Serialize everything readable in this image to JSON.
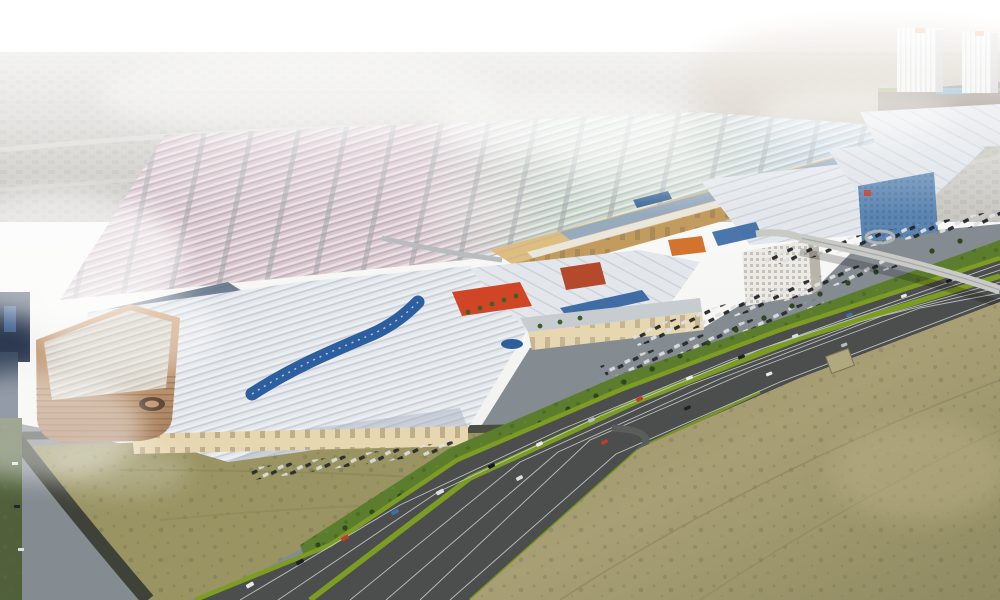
{
  "scene": {
    "kind": "aerial-architectural-rendering",
    "alt": "Bird's-eye rendering of a huge retail and exhibition complex: a colored warehouse-market grid behind, a long tan mall spine with white faceted hall roofs and a curved blue vault, twin white towers upper right, a tan parking garage lower left, lawns and car parks along a multi-lane highway running diagonally, desert in the foreground, haze and fog patches over the scene.",
    "text_content": [],
    "palette": {
      "sky": "#f4f4f1",
      "hazeCity": "#cac8c3",
      "desertFar": "#b5a38a",
      "gridPink": "#d6bfc8",
      "gridGreen": "#c4d2c6",
      "gridBlue": "#b4c8d8",
      "spineTan": "#ddbd80",
      "spineFacade": "#c29c5e",
      "roofWhite": "#e3e7ec",
      "roofShadow": "#a9b4c1",
      "accentRed": "#cf4526",
      "accentBlue": "#2d5f9e",
      "glassBlue": "#5b86b4",
      "creamWall": "#e7d7b0",
      "garageTan": "#c49a78",
      "lawnGreen": "#5c7d2d",
      "medianGreen": "#7d9c22",
      "asphalt": "#4b4e4c",
      "accessRoad": "#848b91",
      "desertNear": "#a29b72",
      "lotSand": "#9a9463",
      "scrubGreen": "#50603a",
      "towerWhite": "#eaebe8",
      "fog": "#ffffff"
    },
    "regions": [
      {
        "id": "sky",
        "label": "hazy white sky"
      },
      {
        "id": "background-cityscape",
        "label": "faint low-rise city blocks fading into haze"
      },
      {
        "id": "far-desert",
        "label": "tan desert haze behind the towers"
      },
      {
        "id": "warehouse-district",
        "label": "grid of warehouse rows tinted pink, green and blue"
      },
      {
        "id": "mall-spine",
        "label": "long tan spine building with glass roof strips"
      },
      {
        "id": "twin-towers",
        "label": "two white high-rise towers on a podium"
      },
      {
        "id": "exhibition-halls",
        "label": "white faceted hall roofs with red and blue accents"
      },
      {
        "id": "dragon-vault",
        "label": "curved blue barrel-vault roof"
      },
      {
        "id": "white-hotel",
        "label": "white mid-rise hotel block"
      },
      {
        "id": "glass-hotel",
        "label": "blue glass hotel block"
      },
      {
        "id": "parking-garage",
        "label": "tan multi-storey car park with rounded corner"
      },
      {
        "id": "parking-lots",
        "label": "surface car parks with rows of parked cars"
      },
      {
        "id": "lawn-verge",
        "label": "landscaped green verge with trees along the highway"
      },
      {
        "id": "flyover-bridge",
        "label": "light concrete flyover crossing the highway"
      },
      {
        "id": "highway",
        "label": "multi-lane highway with green median and traffic"
      },
      {
        "id": "desert-field",
        "label": "mottled desert scrubland in the foreground"
      },
      {
        "id": "sand-lot",
        "label": "empty sand lot bounded by dark roads"
      },
      {
        "id": "fog-patches",
        "label": "white fog and smoke drifting over the site"
      }
    ]
  }
}
